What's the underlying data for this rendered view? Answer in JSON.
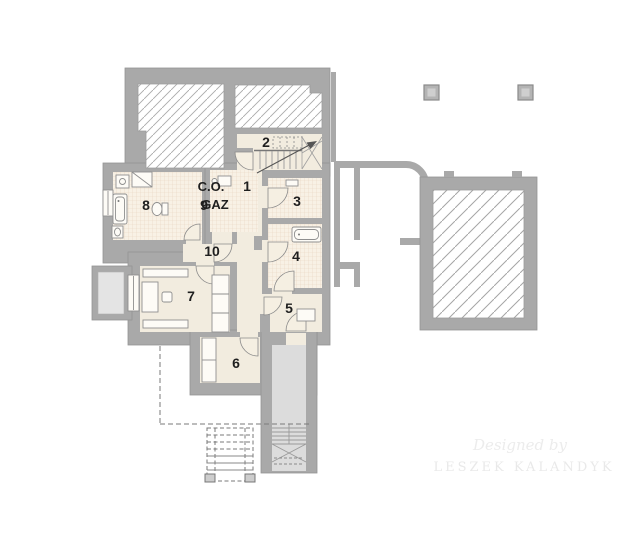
{
  "document": {
    "type": "basement floor plan"
  },
  "rooms": [
    {
      "number": "1"
    },
    {
      "number": "2"
    },
    {
      "number": "3"
    },
    {
      "number": "4"
    },
    {
      "number": "5"
    },
    {
      "number": "6"
    },
    {
      "number": "7"
    },
    {
      "number": "8"
    },
    {
      "number": "9"
    },
    {
      "number": "10"
    }
  ],
  "boiler_label": {
    "line1": "C.O.",
    "line2": "GAZ"
  },
  "watermark": {
    "credit": "Designed by",
    "author": "LESZEK KALANDYK"
  },
  "colors": {
    "wall": "#a9a9a9",
    "floor": "#f2ecdf",
    "tile_floor": "#f8f1e5",
    "stairwell": "#dcdcdc",
    "background": "#ffffff",
    "label_text": "#1f1f1f",
    "watermark_text": "#ebebeb"
  }
}
